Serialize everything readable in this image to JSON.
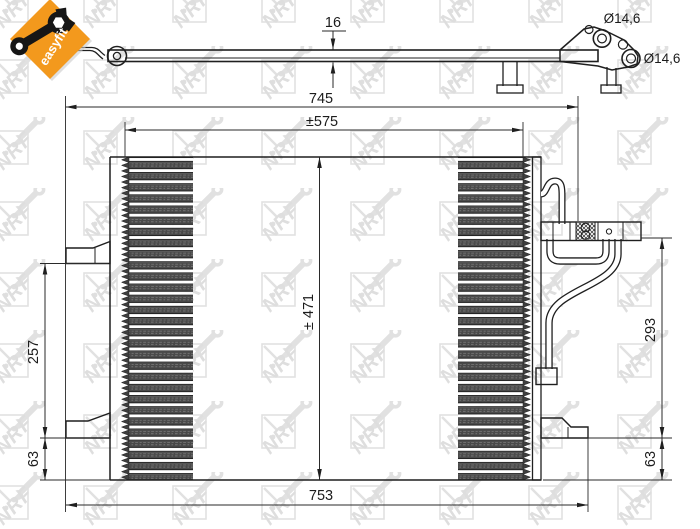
{
  "title": "NRF condenser technical drawing",
  "badge": {
    "label": "easyfit",
    "color": "#f3991d"
  },
  "watermark": {
    "text": "NRF"
  },
  "dimensions": {
    "width_overall": "745",
    "width_core": "±575",
    "depth": "16",
    "port_top_diameter": "Ø14,6",
    "port_right_diameter": "Ø14,6",
    "height_core": "± 471",
    "width_bottom": "753",
    "left_bracket_span": "257",
    "left_bottom_offset": "63",
    "right_fitting_height": "293",
    "right_bottom_offset": "63"
  },
  "colors": {
    "accent_orange": "#f3991d",
    "line": "#1f1f1f",
    "watermark_gray": "#c8c8c8",
    "hatch_dark": "#3e3e3e"
  }
}
